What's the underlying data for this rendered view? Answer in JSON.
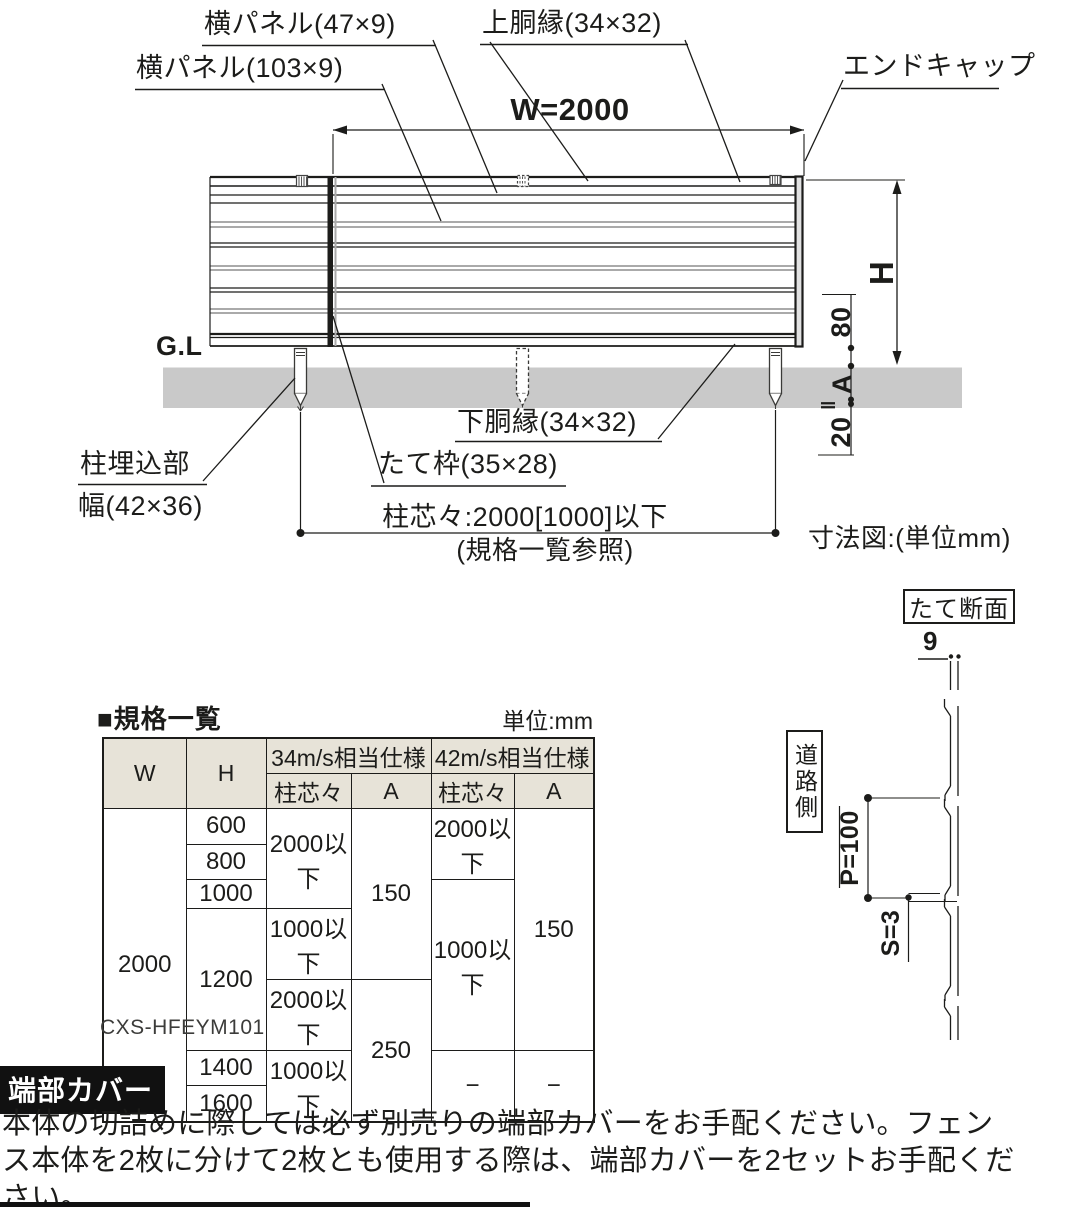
{
  "diagram": {
    "labels": {
      "yoko_panel_47": "横パネル(47×9)",
      "yoko_panel_103": "横パネル(103×9)",
      "upper_rail": "上胴縁(34×32)",
      "end_cap": "エンドキャップ",
      "width_dim": "W=2000",
      "gl": "G.L",
      "height_dim": "H",
      "dim_80": "80",
      "dim_a": "A",
      "dim_parallel": "‖",
      "dim_20": "20",
      "lower_rail": "下胴縁(34×32)",
      "tate_waku": "たて枠(35×28)",
      "post_embed_line1": "柱埋込部",
      "post_embed_line2": "幅(42×36)",
      "post_pitch": "柱芯々:2000[1000]以下",
      "post_pitch_note": "(規格一覧参照)",
      "dim_note": "寸法図:(単位mm)"
    },
    "section": {
      "title": "たて断面",
      "dim_9": "9",
      "road_side": "道路側",
      "dim_p": "P=100",
      "dim_s": "S=3"
    }
  },
  "spec_table": {
    "title": "■規格一覧",
    "unit": "単位:mm",
    "header": {
      "w": "W",
      "h": "H",
      "spec34": "34m/s相当仕様",
      "spec42": "42m/s相当仕様",
      "pitch": "柱芯々",
      "a": "A"
    },
    "w_value": "2000",
    "h_values": [
      "600",
      "800",
      "1000",
      "1200",
      "1400",
      "1600"
    ],
    "cells": {
      "c34_1": "2000以下",
      "c34_2": "1000以下",
      "c34_3": "2000以下",
      "c34_4": "1000以下",
      "a34_1": "150",
      "a34_2": "250",
      "c42_1": "2000以下",
      "c42_2": "1000以下",
      "c42_3": "−",
      "a42_1": "150",
      "a42_2": "−"
    },
    "model": "CXS-HFEYM101"
  },
  "note": {
    "badge": "端部カバー",
    "text": "本体の切詰めに際しては必ず別売りの端部カバーをお手配ください。フェンス本体を2枚に分けて2枚とも使用する際は、端部カバーを2セットお手配ください。"
  },
  "colors": {
    "line": "#1c1c1a",
    "gray_line": "#8d8d8d",
    "ground": "#c9c9c9",
    "table_header_bg": "#e7e3d8",
    "badge_bg": "#111111"
  }
}
